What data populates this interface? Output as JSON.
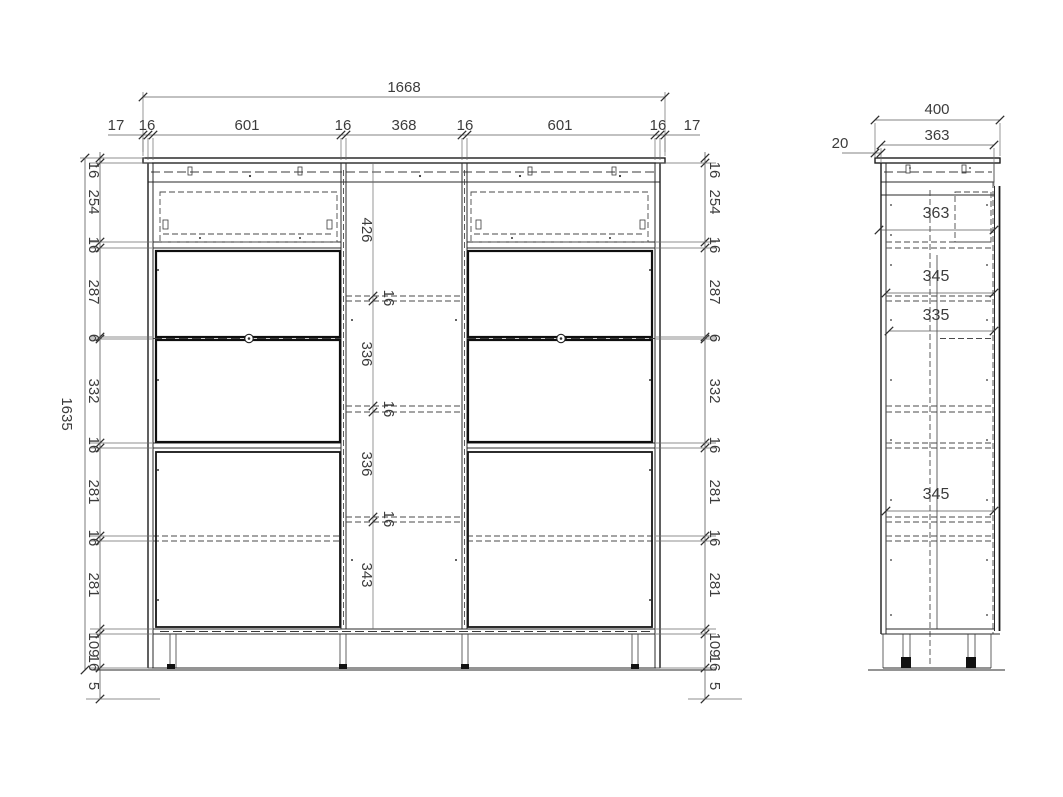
{
  "front_view": {
    "total_width": "1668",
    "total_height": "1635",
    "top_chain": [
      "17",
      "16",
      "601",
      "16",
      "368",
      "16",
      "601",
      "16",
      "17"
    ],
    "left_chain": [
      "16",
      "254",
      "16",
      "287",
      "6",
      "332",
      "16",
      "281",
      "16",
      "281",
      "16",
      "109",
      "5"
    ],
    "right_chain": [
      "16",
      "254",
      "16",
      "287",
      "6",
      "332",
      "16",
      "281",
      "16",
      "281",
      "16",
      "109",
      "5"
    ],
    "center_chain": [
      "426",
      "16",
      "336",
      "16",
      "336",
      "16",
      "343"
    ]
  },
  "side_view": {
    "total_depth": "400",
    "body_depth": "363",
    "back_offset": "20",
    "interior_depths": [
      "363",
      "345",
      "335",
      "345"
    ]
  }
}
